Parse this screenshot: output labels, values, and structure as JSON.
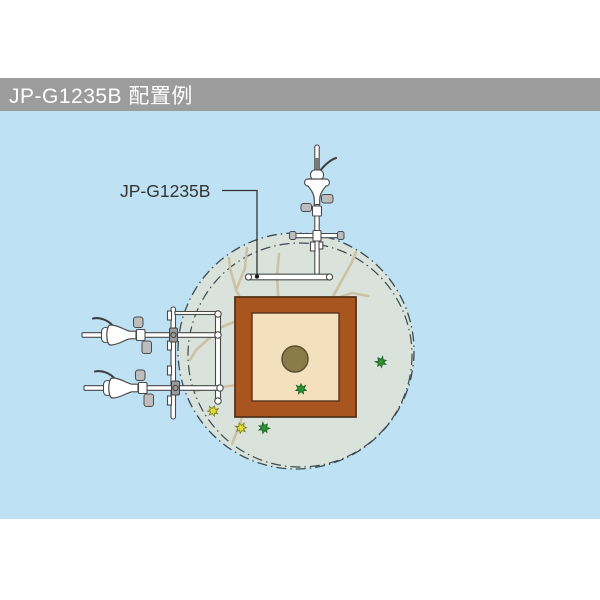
{
  "header": {
    "title": "JP-G1235B 配置例"
  },
  "label": {
    "text": "JP-G1235B"
  },
  "colors": {
    "page-bg": "#FFFFFF",
    "header-bg": "#9C9C9C",
    "header-text": "#FFFFFF",
    "panel-bg": "#BEE2F4",
    "circle-fill": "#D9E3DB",
    "dash": "#3A4A53",
    "planter": "#A8551F",
    "planter-border": "#54341C",
    "soil": "#F5E0BE",
    "trunk": "#8B7B4B",
    "trunk-border": "#5A5130",
    "branch": "#CEC0A2",
    "leaf-green": "#2E9235",
    "leaf-green-border": "#176020",
    "leaf-yellow": "#E5DC36",
    "leaf-yellow-border": "#7A7A17",
    "hw-fill": "#FFFFFF",
    "hw-stroke": "#4A4A4A",
    "knob": "#BDBDBD",
    "label-text": "#333333",
    "leader": "#333333"
  },
  "diagram": {
    "spray_circle": {
      "cx": 296,
      "cy": 351,
      "r": 118
    },
    "spray_circle_inner": {
      "cx": 300,
      "cy": 355,
      "r": 112
    },
    "planter": {
      "x": 235,
      "y": 297,
      "w": 121,
      "h": 120
    },
    "soil": {
      "x": 252,
      "y": 313,
      "w": 87,
      "h": 88
    },
    "trunk": {
      "cx": 295,
      "cy": 359,
      "r": 13
    },
    "branches": [
      [
        [
          296,
          358
        ],
        [
          276,
          342
        ],
        [
          250,
          315
        ],
        [
          236,
          290
        ],
        [
          230,
          268
        ],
        [
          229,
          258
        ]
      ],
      [
        [
          250,
          315
        ],
        [
          222,
          327
        ],
        [
          196,
          350
        ],
        [
          190,
          360
        ]
      ],
      [
        [
          236,
          290
        ],
        [
          245,
          268
        ],
        [
          247,
          248
        ]
      ],
      [
        [
          296,
          358
        ],
        [
          289,
          330
        ],
        [
          279,
          310
        ],
        [
          277,
          275
        ],
        [
          279,
          254
        ]
      ],
      [
        [
          296,
          358
        ],
        [
          312,
          332
        ],
        [
          331,
          300
        ],
        [
          352,
          262
        ],
        [
          356,
          252
        ]
      ],
      [
        [
          331,
          300
        ],
        [
          352,
          293
        ],
        [
          368,
          296
        ]
      ],
      [
        [
          296,
          358
        ],
        [
          276,
          372
        ],
        [
          257,
          381
        ],
        [
          246,
          402
        ],
        [
          240,
          424
        ],
        [
          232,
          444
        ]
      ],
      [
        [
          257,
          381
        ],
        [
          230,
          386
        ],
        [
          204,
          389
        ],
        [
          196,
          391
        ]
      ]
    ],
    "leaves": [
      {
        "x": 213,
        "y": 411,
        "color": "yellow",
        "rot": 15
      },
      {
        "x": 241,
        "y": 428,
        "color": "yellow",
        "rot": -20
      },
      {
        "x": 264,
        "y": 428,
        "color": "green",
        "rot": 40
      },
      {
        "x": 301,
        "y": 389,
        "color": "green",
        "rot": 0
      },
      {
        "x": 381,
        "y": 362,
        "color": "green",
        "rot": -35
      }
    ],
    "side_sprinklers": [
      {
        "x": 140,
        "y": 335
      },
      {
        "x": 142,
        "y": 388
      }
    ],
    "leader_path": "222,190.5 257,190.5 257,274",
    "leader_dot": {
      "cx": 257,
      "cy": 276.5,
      "r": 2.2
    }
  }
}
